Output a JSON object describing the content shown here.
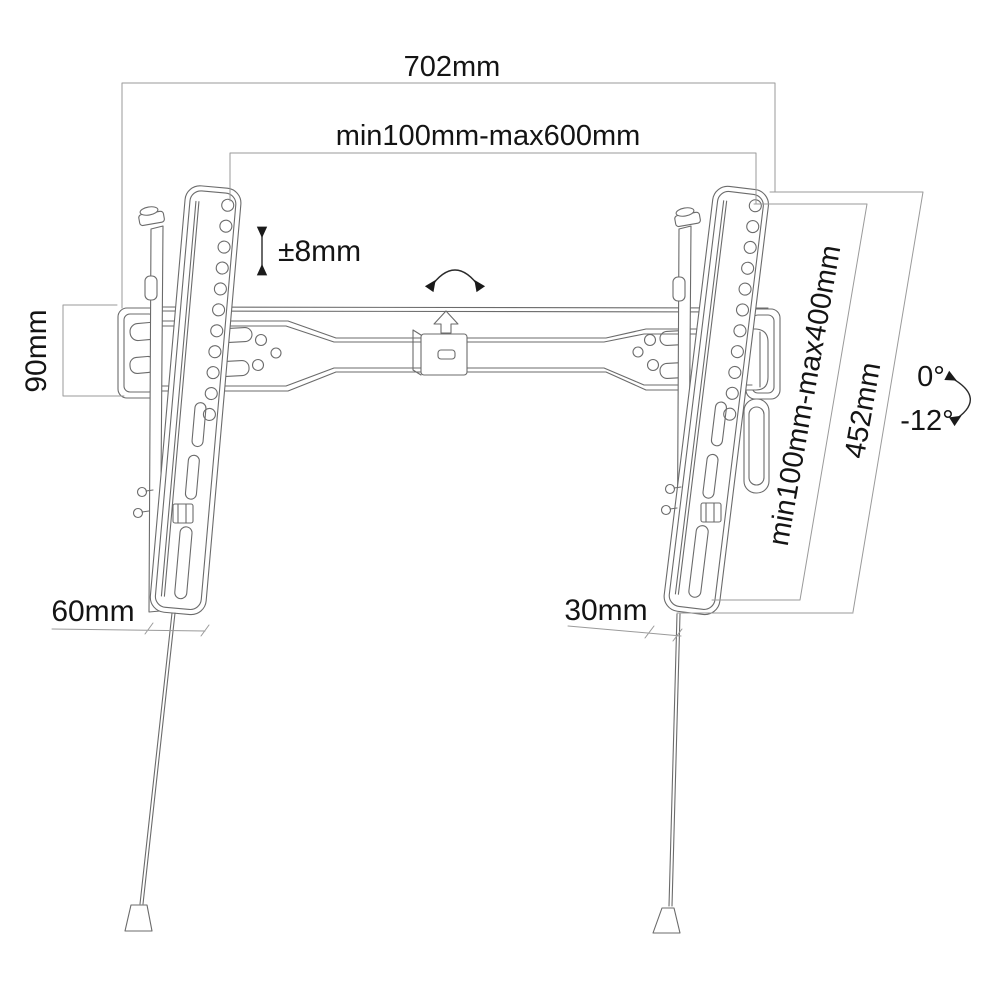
{
  "diagram": {
    "type": "technical dimension drawing",
    "subject": "Tilting TV wall mount bracket with safety pull cords",
    "labels": {
      "overall_width": "702mm",
      "mount_width_range": "min100mm-max600mm",
      "height_adjustment": "±8mm",
      "wall_plate_height": "90mm",
      "mount_height_range": "min100mm-max400mm",
      "bracket_height": "452mm",
      "tilt_upper": "0°",
      "tilt_lower": "-12°",
      "bottom_offset_left": "60mm",
      "bottom_offset_right": "30mm"
    },
    "colors": {
      "background": "#ffffff",
      "drawing_line": "#6b6b6b",
      "dimension_line": "#9a9a9a",
      "label_text": "#141414"
    }
  }
}
